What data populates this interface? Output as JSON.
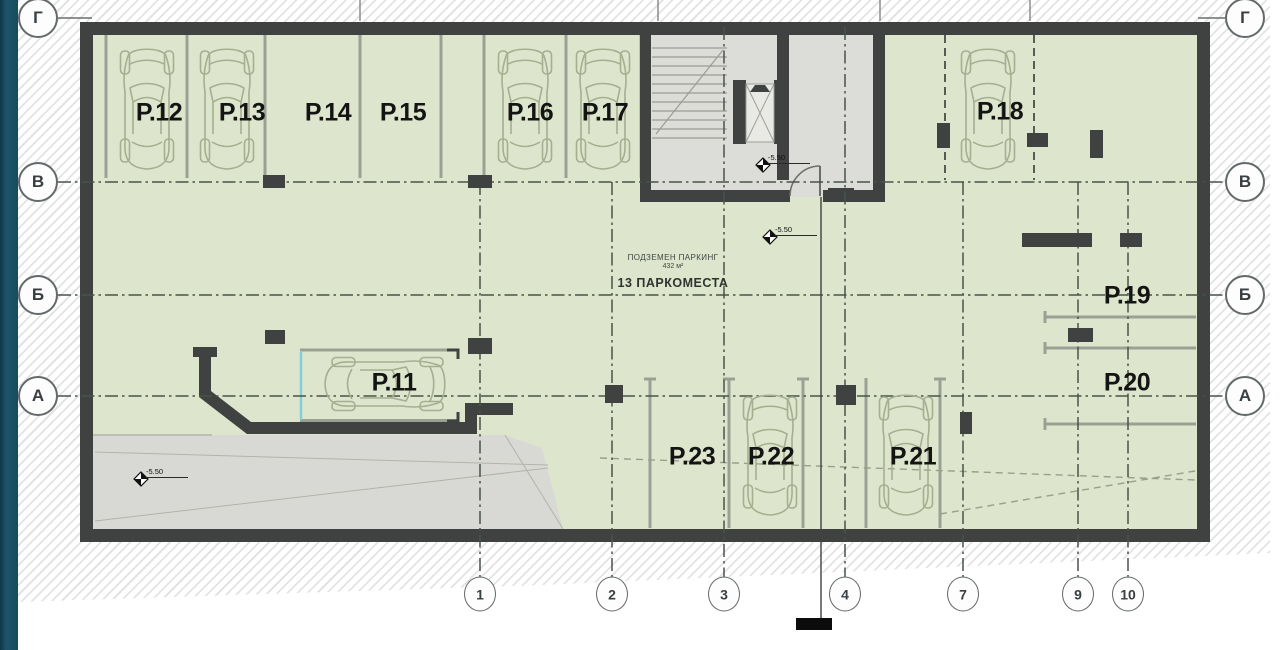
{
  "document": {
    "type": "architectural floor plan",
    "level_name": "underground parking level"
  },
  "plan": {
    "info_text": {
      "line1": "ПОДЗЕМЕН ПАРКИНГ",
      "line2": "432 м²",
      "line3": "13 ПАРКОМЕСТА"
    },
    "spots": [
      {
        "id": "P.11",
        "x": 394,
        "y": 383
      },
      {
        "id": "P.12",
        "x": 159,
        "y": 113
      },
      {
        "id": "P.13",
        "x": 242,
        "y": 113
      },
      {
        "id": "P.14",
        "x": 328,
        "y": 113
      },
      {
        "id": "P.15",
        "x": 403,
        "y": 113
      },
      {
        "id": "P.16",
        "x": 530,
        "y": 113
      },
      {
        "id": "P.17",
        "x": 605,
        "y": 113
      },
      {
        "id": "P.18",
        "x": 1000,
        "y": 112
      },
      {
        "id": "P.19",
        "x": 1127,
        "y": 296
      },
      {
        "id": "P.20",
        "x": 1127,
        "y": 383
      },
      {
        "id": "P.21",
        "x": 913,
        "y": 457
      },
      {
        "id": "P.22",
        "x": 771,
        "y": 457
      },
      {
        "id": "P.23",
        "x": 692,
        "y": 457
      }
    ],
    "cars": [
      {
        "spot": "P.12",
        "cx": 147,
        "cy": 107,
        "rot": 0
      },
      {
        "spot": "P.13",
        "cx": 227,
        "cy": 107,
        "rot": 0
      },
      {
        "spot": "P.16",
        "cx": 525,
        "cy": 107,
        "rot": 0
      },
      {
        "spot": "P.17",
        "cx": 603,
        "cy": 107,
        "rot": 0
      },
      {
        "spot": "P.18",
        "cx": 988,
        "cy": 107,
        "rot": 0
      },
      {
        "spot": "P.22",
        "cx": 770,
        "cy": 453,
        "rot": 0
      },
      {
        "spot": "P.21",
        "cx": 906,
        "cy": 453,
        "rot": 0
      },
      {
        "spot": "P.11",
        "cx": 387,
        "cy": 384,
        "rot": 90
      }
    ],
    "elevation_markers": [
      {
        "value": "-5.50",
        "x": 763,
        "y": 165
      },
      {
        "value": "-5.50",
        "x": 770,
        "y": 237
      },
      {
        "value": "-5.50",
        "x": 141,
        "y": 479
      }
    ]
  },
  "axes": {
    "left": [
      {
        "label": "Г",
        "y": 18
      },
      {
        "label": "В",
        "y": 182
      },
      {
        "label": "Б",
        "y": 295
      },
      {
        "label": "А",
        "y": 396
      }
    ],
    "right": [
      {
        "label": "Г",
        "y": 18
      },
      {
        "label": "В",
        "y": 182
      },
      {
        "label": "Б",
        "y": 295
      },
      {
        "label": "А",
        "y": 396
      }
    ],
    "bottom": [
      {
        "label": "1",
        "x": 480
      },
      {
        "label": "2",
        "x": 612
      },
      {
        "label": "3",
        "x": 724
      },
      {
        "label": "4",
        "x": 845
      },
      {
        "label": "7",
        "x": 963
      },
      {
        "label": "9",
        "x": 1078
      },
      {
        "label": "10",
        "x": 1128
      }
    ]
  },
  "colors": {
    "accent_bar": "#1b5065",
    "floor": "#dde6cc",
    "core_gray": "#dcddd9",
    "ramp_gray": "#d8d9d4",
    "wall": "#3f4240",
    "stall_line": "#9aa094",
    "car_line": "#a6ae90",
    "grid_line": "#49524a",
    "text": "#141414"
  }
}
